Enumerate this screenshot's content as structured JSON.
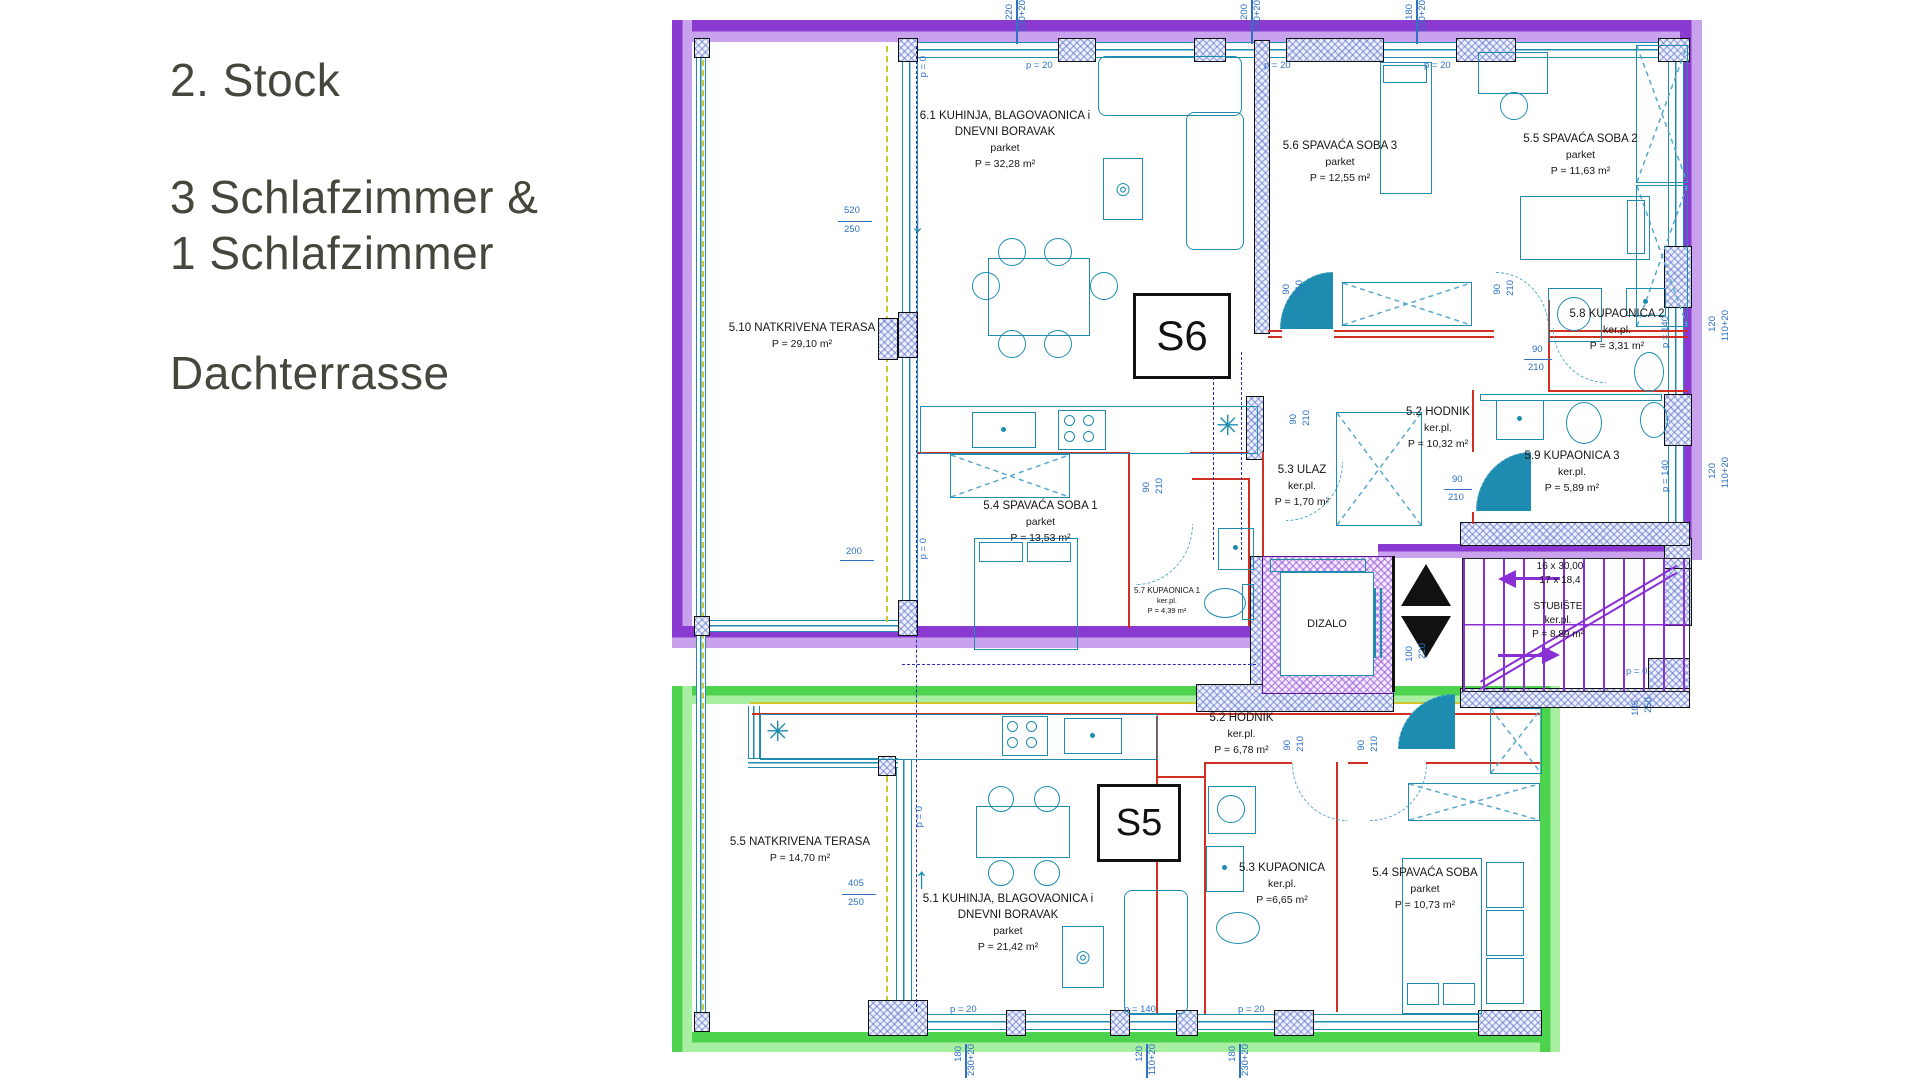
{
  "sidebar": {
    "title": "2. Stock",
    "line2": "3 Schlafzimmer &",
    "line3": "1 Schlafzimmer",
    "line4": "Dachterrasse",
    "text_color": "#45463c"
  },
  "colors": {
    "unit_s6_outline": "#8a3ad0",
    "unit_s5_outline": "#4ed34e",
    "walls_hatch": "#5a6ecd",
    "partitions": "#d03022",
    "fixtures": "#1d8cb0",
    "dimensions": "#2f72c4",
    "stairs": "#8a2fd6"
  },
  "icons": {
    "target_icon": "◎",
    "vent_icon": "✳",
    "arrow_down": "↓",
    "arrow_up": "↑"
  },
  "plan": {
    "s6": {
      "label": "S6",
      "rooms": [
        {
          "name": "6.1 KUHINJA, BLAGOVAONICA i",
          "name2": "DNEVNI BORAVAK",
          "finish": "parket",
          "area": "P = 32,28 m²"
        },
        {
          "name": "5.6 SPAVAĆA SOBA 3",
          "finish": "parket",
          "area": "P = 12,55 m²"
        },
        {
          "name": "5.5 SPAVAĆA SOBA 2",
          "finish": "parket",
          "area": "P = 11,63 m²"
        },
        {
          "name": "5.8 KUPAONICA 2",
          "finish": "ker.pl.",
          "area": "P = 3,31 m²"
        },
        {
          "name": "5.2 HODNIK",
          "finish": "ker.pl.",
          "area": "P = 10,32 m²"
        },
        {
          "name": "5.3 ULAZ",
          "finish": "ker.pl.",
          "area": "P = 1,70 m²"
        },
        {
          "name": "5.9 KUPAONICA 3",
          "finish": "ker.pl.",
          "area": "P = 5,89 m²"
        },
        {
          "name": "5.4 SPAVAĆA SOBA 1",
          "finish": "parket",
          "area": "P = 13,53 m²"
        },
        {
          "name": "5.7 KUPAONICA 1",
          "finish": "ker.pl.",
          "area": "P = 4,39 m²"
        },
        {
          "name": "5.10 NATKRIVENA TERASA",
          "area": "P = 29,10 m²"
        }
      ]
    },
    "s5": {
      "label": "S5",
      "rooms": [
        {
          "name": "5.2 HODNIK",
          "finish": "ker.pl.",
          "area": "P = 6,78 m²"
        },
        {
          "name": "5.1 KUHINJA, BLAGOVAONICA i",
          "name2": "DNEVNI BORAVAK",
          "finish": "parket",
          "area": "P = 21,42 m²"
        },
        {
          "name": "5.3 KUPAONICA",
          "finish": "ker.pl.",
          "area": "P =6,65 m²"
        },
        {
          "name": "5.4 SPAVAĆA SOBA",
          "finish": "parket",
          "area": "P = 10,73 m²"
        },
        {
          "name": "5.5 NATKRIVENA TERASA",
          "area": "P = 14,70 m²"
        }
      ]
    },
    "core": {
      "elevator": "DIZALO",
      "stairs_count": "16 x 30,00",
      "stairs_rise": "17 x 18,4",
      "stairs_name": "STUBIŠTE",
      "stairs_finish": "ker.pl.",
      "stairs_area": "P = 8,89 m²"
    },
    "dims": {
      "d1": "220",
      "d2": "230+20",
      "d3": "200",
      "d4": "230+20",
      "d5": "180",
      "d6": "230+20",
      "d7": "p = 20",
      "d8": "p = 20",
      "d9": "p = 20",
      "d10": "520",
      "d11": "250",
      "d12": "200",
      "d13": "405",
      "d14": "250",
      "d15": "p = 0",
      "d16": "p = 0",
      "d17": "p = 0",
      "d18": "90",
      "d19": "210",
      "d20": "90",
      "d21": "210",
      "d22": "90",
      "d23": "210",
      "d24": "90",
      "d25": "210",
      "d26": "90",
      "d27": "210",
      "d28": "90",
      "d29": "210",
      "d30": "90",
      "d31": "210",
      "d32": "90",
      "d33": "210",
      "d34": "100",
      "d35": "220",
      "d36": "120",
      "d37": "110+20",
      "d38": "120",
      "d39": "110+20",
      "d40": "p = 140",
      "d41": "p = 140",
      "d42": "105",
      "d43": "250",
      "d44": "p = 0",
      "d45": "p = 20",
      "d46": "p = 140",
      "d47": "p = 20",
      "d48": "180",
      "d49": "230+20",
      "d50": "120",
      "d51": "110+20",
      "d52": "180",
      "d53": "230+20"
    }
  }
}
